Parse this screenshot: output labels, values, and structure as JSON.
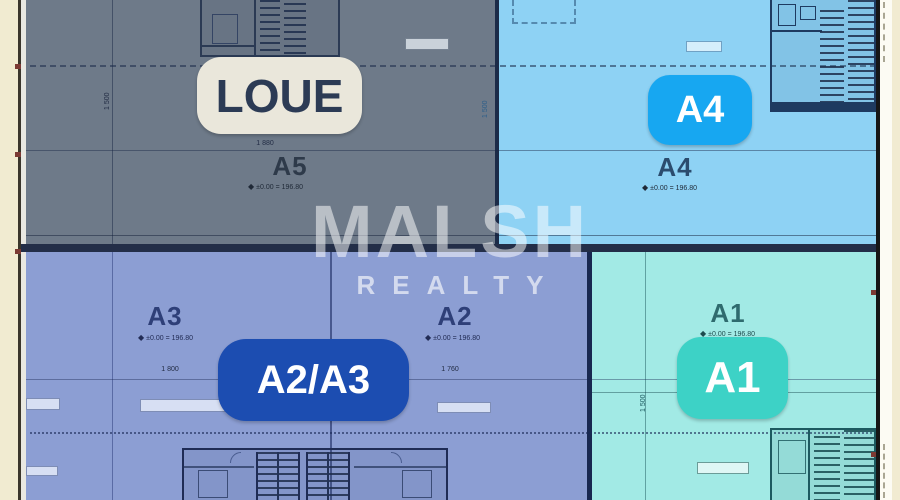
{
  "brand": {
    "name": "MALSH",
    "subtitle": "REALTY"
  },
  "badges": {
    "loue": "LOUE",
    "a4": "A4",
    "a2a3": "A2/A3",
    "a1": "A1"
  },
  "plan_labels": {
    "a5": "A5",
    "a4": "A4",
    "a3": "A3",
    "a2": "A2",
    "a1": "A1"
  },
  "elevation_text": "±0.00 = 196.80",
  "benchmark_symbol": "◆",
  "dimensions": {
    "a5_width": "1 880",
    "a3_width": "1 800",
    "a2_width": "1 760",
    "a5_height": "1 500",
    "a4_height": "1 500",
    "a1_height": "1 500"
  },
  "colors": {
    "page_background": "#f1ebd1",
    "unit_a5_fill": "#6e7a89",
    "unit_a4_fill": "#8ed2f4",
    "unit_a2_a3_fill": "#8c9ed3",
    "unit_a1_fill": "#a2eae5",
    "wall_dark": "#232e48",
    "badge_loue_bg": "#eae7db",
    "badge_loue_text": "#2c3b55",
    "badge_a4_bg": "#17a7f1",
    "badge_a2a3_bg": "#1c4db1",
    "badge_a1_bg": "#3dd2c6",
    "badge_text": "#ffffff",
    "watermark": "#ffffff"
  }
}
